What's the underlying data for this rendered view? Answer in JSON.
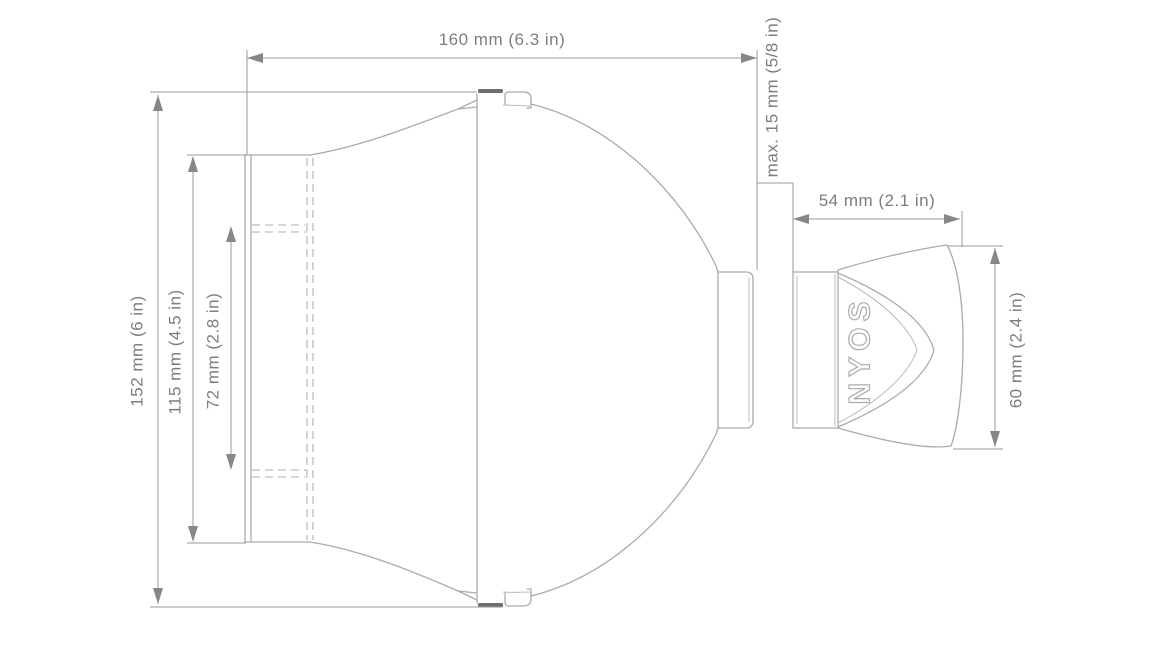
{
  "diagram": {
    "title": "Device dimension drawing",
    "background_color": "#ffffff",
    "outline_color": "#a9abad",
    "dimension_line_color": "#9a9a9e",
    "text_color": "#7d7d82",
    "logo_text": "NYOS",
    "dimensions": {
      "overall_width": "160 mm (6.3 in)",
      "glass_thickness_max": "max. 15 mm (5/8 in)",
      "magnet_holder_width": "54 mm (2.1 in)",
      "overall_height": "152 mm (6 in)",
      "plate_height": "115 mm (4.5 in)",
      "slot_spacing_height": "72 mm (2.8 in)",
      "magnet_holder_height": "60 mm (2.4 in)"
    }
  }
}
